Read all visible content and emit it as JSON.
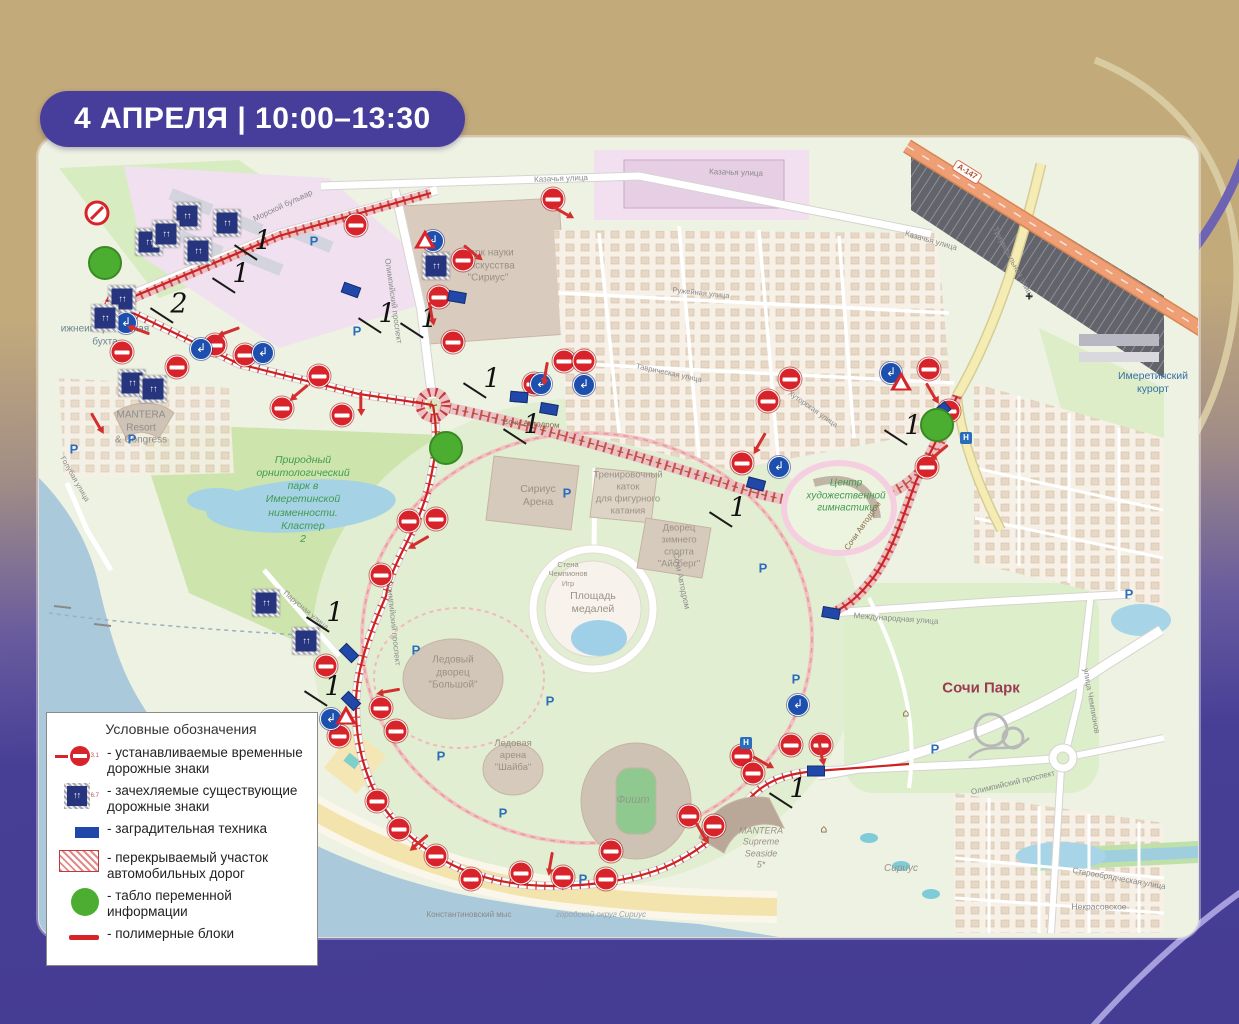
{
  "badge": {
    "text": "4 АПРЕЛЯ | 10:00–13:30"
  },
  "legend": {
    "title": "Условные обозначения",
    "items": [
      {
        "icon": "temporary-sign-icon",
        "code": "3.1",
        "label": "- устанавливаемые временные дорожные знаки"
      },
      {
        "icon": "covered-sign-icon",
        "code": "6.7",
        "label": "- зачехляемые существующие дорожные знаки"
      },
      {
        "icon": "barrier-icon",
        "code": "",
        "label": "- заградительная техника"
      },
      {
        "icon": "closed-road-icon",
        "code": "",
        "label": "- перекрываемый участок автомобильных дорог"
      },
      {
        "icon": "info-board-icon",
        "code": "",
        "label": "- табло переменной информации"
      },
      {
        "icon": "polymer-block-icon",
        "code": "",
        "label": "- полимерные блоки"
      }
    ]
  },
  "map": {
    "labels": [
      {
        "t": "ижнеимеретинская\nбухта",
        "x": 66,
        "y": 198,
        "s": 10,
        "c": "#6b8693"
      },
      {
        "t": "MANTERA\nResort\n& Congress",
        "x": 102,
        "y": 290,
        "s": 10,
        "c": "#8d8d8d"
      },
      {
        "t": "Голубая улица",
        "x": 36,
        "y": 341,
        "s": 7.5,
        "c": "#8a8a8a",
        "r": 60
      },
      {
        "t": "Парусная улица",
        "x": 267,
        "y": 472,
        "s": 7.5,
        "c": "#8a8a8a",
        "r": 40
      },
      {
        "t": "Природный\nорнитологический\nпарк в\nИмеретинской\nнизменности.\nКластер\n2",
        "x": 264,
        "y": 362,
        "s": 10.5,
        "c": "#3f9b4f",
        "i": 1
      },
      {
        "t": "Сириус\nАрена",
        "x": 499,
        "y": 358,
        "s": 10.5,
        "c": "#9a9186"
      },
      {
        "t": "Тренировочный\nкаток\nдля фигурного\nкатания",
        "x": 589,
        "y": 355,
        "s": 9.5,
        "c": "#9a9186"
      },
      {
        "t": "Дворец\nзимнего\nспорта\n\"Айсберг\"",
        "x": 640,
        "y": 408,
        "s": 9.5,
        "c": "#9a9186"
      },
      {
        "t": "Площадь\nмедалей",
        "x": 554,
        "y": 465,
        "s": 10.5,
        "c": "#9a9186"
      },
      {
        "t": "Стена\nЧемпионов\nИгр",
        "x": 529,
        "y": 436,
        "s": 7.5,
        "c": "#9a9186"
      },
      {
        "t": "Ледовый\nдворец\n\"Большой\"",
        "x": 414,
        "y": 535,
        "s": 10,
        "c": "#9a9186"
      },
      {
        "t": "Ледовая\nарена\n\"Шайба\"",
        "x": 474,
        "y": 618,
        "s": 9.5,
        "c": "#9a9186"
      },
      {
        "t": "Фишт",
        "x": 594,
        "y": 663,
        "s": 11,
        "c": "#8e9c8a",
        "i": 1
      },
      {
        "t": "Центр\nхудожественной\nгимнастики",
        "x": 807,
        "y": 358,
        "s": 10,
        "c": "#3f9b4f",
        "i": 1
      },
      {
        "t": "Сочи Парк",
        "x": 942,
        "y": 551,
        "s": 15,
        "c": "#9c3a52",
        "b": 1
      },
      {
        "t": "Имеретинский\nкурорт",
        "x": 1114,
        "y": 245,
        "s": 10.5,
        "c": "#3a6ea8"
      },
      {
        "t": "MANTERA\nSupreme\nSeaside\n5*",
        "x": 722,
        "y": 710,
        "s": 9,
        "c": "#9a9186",
        "i": 1
      },
      {
        "t": "Сириус",
        "x": 862,
        "y": 731,
        "s": 10,
        "c": "#9a9186",
        "i": 1
      },
      {
        "t": "городской округ Сириус",
        "x": 562,
        "y": 777,
        "s": 8,
        "c": "#97a3ae",
        "i": 1
      },
      {
        "t": "Константиновский мыс",
        "x": 430,
        "y": 777,
        "s": 8,
        "c": "#8a8a8a"
      },
      {
        "t": "Сочи Автодром",
        "x": 492,
        "y": 286,
        "s": 8,
        "c": "#8a6a4a",
        "r": 4
      },
      {
        "t": "Сочи Автодром",
        "x": 824,
        "y": 388,
        "s": 8,
        "c": "#8a6a4a",
        "r": -55
      },
      {
        "t": "Сочи Автодром",
        "x": 642,
        "y": 443,
        "s": 8,
        "c": "#8a8a8a",
        "r": 78
      },
      {
        "t": "Казачья улица",
        "x": 522,
        "y": 41,
        "s": 8,
        "c": "#8a8a8a",
        "r": -2
      },
      {
        "t": "Казачья улица",
        "x": 697,
        "y": 35,
        "s": 8,
        "c": "#8a8a8a",
        "r": 2
      },
      {
        "t": "Казачья улица",
        "x": 892,
        "y": 103,
        "s": 8,
        "c": "#8a8a8a",
        "r": 16
      },
      {
        "t": "Триумфальная улица",
        "x": 974,
        "y": 125,
        "s": 8,
        "c": "#8a8a8a",
        "r": 62
      },
      {
        "t": "Олимпийский проспект",
        "x": 354,
        "y": 163,
        "s": 8,
        "c": "#8a8a8a",
        "r": 82
      },
      {
        "t": "Олимпийский проспект",
        "x": 354,
        "y": 485,
        "s": 8,
        "c": "#8a8a8a",
        "r": 84
      },
      {
        "t": "Олимпийский проспект",
        "x": 974,
        "y": 645,
        "s": 8,
        "c": "#8a8a8a",
        "r": -13
      },
      {
        "t": "Морской бульвар",
        "x": 244,
        "y": 68,
        "s": 8,
        "c": "#8a8a8a",
        "r": -25
      },
      {
        "t": "Международная улица",
        "x": 857,
        "y": 481,
        "s": 8,
        "c": "#8a8a8a",
        "r": 4
      },
      {
        "t": "Старообрядческая улица",
        "x": 1080,
        "y": 741,
        "s": 8,
        "c": "#8a8a8a",
        "r": 10
      },
      {
        "t": "Некрасовское",
        "x": 1060,
        "y": 769,
        "s": 8.5,
        "c": "#8a8a8a"
      },
      {
        "t": "улица Чемпионов",
        "x": 1052,
        "y": 563,
        "s": 8,
        "c": "#8a8a8a",
        "r": 80
      },
      {
        "t": "Хуторская улица",
        "x": 774,
        "y": 271,
        "s": 7.5,
        "c": "#8a8a8a",
        "r": 35
      },
      {
        "t": "Ружейная улица",
        "x": 662,
        "y": 155,
        "s": 7.5,
        "c": "#8a8a8a",
        "r": 6
      },
      {
        "t": "Таврическая улица",
        "x": 630,
        "y": 235,
        "s": 7.5,
        "c": "#8a8a8a",
        "r": 12
      },
      {
        "t": "Парк науки\nи искусства\n\"Сириус\"",
        "x": 449,
        "y": 128,
        "s": 10,
        "c": "#9a9186"
      },
      {
        "t": "А-147",
        "x": 928,
        "y": 34,
        "s": 8,
        "c": "#b05030",
        "r": 32,
        "bg": 1
      }
    ],
    "markers": {
      "no_entry": [
        [
          317,
          87
        ],
        [
          83,
          214
        ],
        [
          138,
          229
        ],
        [
          176,
          207
        ],
        [
          206,
          217
        ],
        [
          243,
          270
        ],
        [
          280,
          238
        ],
        [
          303,
          277
        ],
        [
          400,
          159
        ],
        [
          414,
          204
        ],
        [
          424,
          122
        ],
        [
          514,
          61
        ],
        [
          495,
          246
        ],
        [
          525,
          223
        ],
        [
          545,
          223
        ],
        [
          703,
          325
        ],
        [
          729,
          263
        ],
        [
          751,
          241
        ],
        [
          890,
          231
        ],
        [
          910,
          273
        ],
        [
          888,
          329
        ],
        [
          397,
          381
        ],
        [
          370,
          383
        ],
        [
          342,
          437
        ],
        [
          287,
          528
        ],
        [
          300,
          598
        ],
        [
          342,
          570
        ],
        [
          357,
          593
        ],
        [
          338,
          663
        ],
        [
          360,
          691
        ],
        [
          397,
          718
        ],
        [
          432,
          741
        ],
        [
          482,
          735
        ],
        [
          524,
          739
        ],
        [
          567,
          741
        ],
        [
          572,
          713
        ],
        [
          650,
          678
        ],
        [
          675,
          688
        ],
        [
          703,
          618
        ],
        [
          714,
          635
        ],
        [
          752,
          607
        ],
        [
          782,
          607
        ]
      ],
      "no_stopping": [
        [
          58,
          75
        ]
      ],
      "turn_signs": [
        [
          87,
          185
        ],
        [
          162,
          211
        ],
        [
          224,
          215
        ],
        [
          502,
          246
        ],
        [
          545,
          247
        ],
        [
          740,
          329
        ],
        [
          852,
          235
        ],
        [
          759,
          567
        ],
        [
          394,
          103
        ],
        [
          292,
          581
        ]
      ],
      "covered_signs": [
        [
          148,
          78
        ],
        [
          188,
          85
        ],
        [
          110,
          104
        ],
        [
          159,
          113
        ],
        [
          127,
          96
        ],
        [
          83,
          161
        ],
        [
          66,
          180
        ],
        [
          93,
          245
        ],
        [
          114,
          251
        ],
        [
          227,
          465
        ],
        [
          267,
          503
        ],
        [
          397,
          128
        ]
      ],
      "barriers": [
        [
          312,
          152,
          20
        ],
        [
          418,
          159,
          10
        ],
        [
          480,
          259,
          5
        ],
        [
          510,
          271,
          10
        ],
        [
          717,
          346,
          15
        ],
        [
          902,
          273,
          -40
        ],
        [
          792,
          475,
          10
        ],
        [
          310,
          515,
          45
        ],
        [
          312,
          563,
          45
        ],
        [
          777,
          633,
          0
        ]
      ],
      "info_boards": [
        [
          66,
          125
        ],
        [
          407,
          310
        ],
        [
          898,
          287
        ]
      ],
      "warning_triangles": [
        [
          386,
          101
        ],
        [
          862,
          243
        ],
        [
          307,
          577
        ]
      ],
      "numbers": [
        {
          "t": "1",
          "x": 224,
          "y": 103
        },
        {
          "t": "1",
          "x": 202,
          "y": 136
        },
        {
          "t": "2",
          "x": 140,
          "y": 166
        },
        {
          "t": "1",
          "x": 348,
          "y": 176
        },
        {
          "t": "1",
          "x": 390,
          "y": 181
        },
        {
          "t": "1",
          "x": 453,
          "y": 241
        },
        {
          "t": "1",
          "x": 493,
          "y": 287
        },
        {
          "t": "1",
          "x": 699,
          "y": 370
        },
        {
          "t": "1",
          "x": 874,
          "y": 288
        },
        {
          "t": "1",
          "x": 296,
          "y": 475
        },
        {
          "t": "1",
          "x": 294,
          "y": 549
        },
        {
          "t": "1",
          "x": 759,
          "y": 651
        }
      ],
      "arrows": [
        [
          102,
          193,
          200
        ],
        [
          192,
          193,
          160
        ],
        [
          262,
          253,
          140
        ],
        [
          322,
          263,
          90
        ],
        [
          392,
          173,
          80
        ],
        [
          432,
          113,
          40
        ],
        [
          522,
          73,
          30
        ],
        [
          507,
          233,
          100
        ],
        [
          722,
          303,
          120
        ],
        [
          892,
          253,
          60
        ],
        [
          902,
          313,
          140
        ],
        [
          382,
          403,
          150
        ],
        [
          352,
          553,
          170
        ],
        [
          382,
          703,
          140
        ],
        [
          512,
          723,
          100
        ],
        [
          662,
          693,
          60
        ],
        [
          722,
          623,
          30
        ],
        [
          782,
          613,
          80
        ],
        [
          57,
          283,
          60
        ]
      ],
      "parking": [
        [
          275,
          103
        ],
        [
          318,
          193
        ],
        [
          35,
          311
        ],
        [
          93,
          301
        ],
        [
          528,
          355
        ],
        [
          724,
          430
        ],
        [
          377,
          512
        ],
        [
          402,
          618
        ],
        [
          464,
          675
        ],
        [
          544,
          741
        ],
        [
          757,
          541
        ],
        [
          896,
          611
        ],
        [
          1090,
          456
        ],
        [
          511,
          563
        ]
      ],
      "hotels": [
        [
          927,
          300
        ],
        [
          707,
          605
        ]
      ],
      "museums": [
        [
          867,
          575
        ],
        [
          785,
          691
        ]
      ],
      "churches": [
        [
          990,
          158
        ]
      ]
    },
    "icon_glyphs": {
      "turn_arrow": "↲",
      "lane_arrows": "↑↑",
      "parking_letter": "Р",
      "hotel_letter": "Н",
      "museum_glyph": "⌂",
      "church_glyph": "+"
    },
    "colors": {
      "accent_purple": "#473e9b",
      "closure_red": "#d8232a",
      "route_red": "#cc2222",
      "info_green": "#4cae30",
      "barrier_blue": "#2148a8",
      "sea": "#aac9da",
      "sand_tan": "#c3aa7b"
    }
  }
}
